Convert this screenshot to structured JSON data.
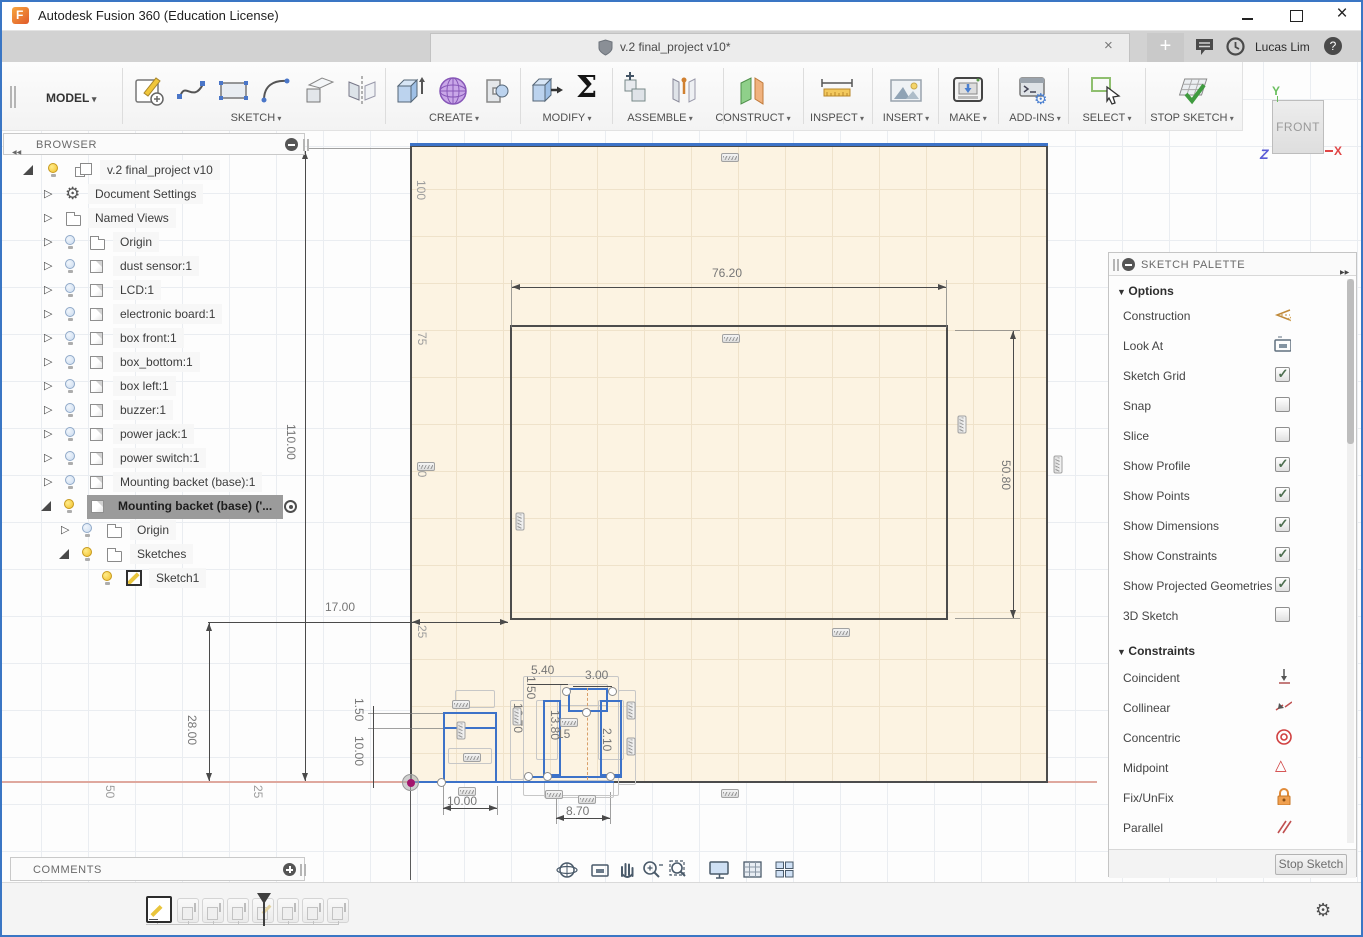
{
  "window": {
    "title": "Autodesk Fusion 360 (Education License)"
  },
  "appbar": {
    "tab_title": "v.2 final_project v10*",
    "user": "Lucas Lim",
    "left_icons": [
      "app-grid",
      "file-new",
      "save",
      "undo",
      "redo"
    ],
    "right_icons": [
      "new-tab-plus",
      "comments-bubble",
      "job-status-clock",
      "help"
    ]
  },
  "toolbar": {
    "workspace": "MODEL",
    "groups": [
      {
        "label": "SKETCH",
        "icons": [
          "create-sketch",
          "spline",
          "rectangle",
          "arc",
          "project-include",
          "mirror"
        ]
      },
      {
        "label": "CREATE",
        "icons": [
          "extrude",
          "form",
          "revolve"
        ]
      },
      {
        "label": "MODIFY",
        "icons": [
          "press-pull",
          "change-parameters"
        ]
      },
      {
        "label": "ASSEMBLE",
        "icons": [
          "new-component",
          "joint"
        ]
      },
      {
        "label": "CONSTRUCT",
        "icons": [
          "construction-plane"
        ]
      },
      {
        "label": "INSPECT",
        "icons": [
          "measure"
        ]
      },
      {
        "label": "INSERT",
        "icons": [
          "insert-image"
        ]
      },
      {
        "label": "MAKE",
        "icons": [
          "3d-print"
        ]
      },
      {
        "label": "ADD-INS",
        "icons": [
          "scripts-addins"
        ]
      },
      {
        "label": "SELECT",
        "icons": [
          "select-cursor"
        ]
      },
      {
        "label": "STOP SKETCH",
        "icons": [
          "stop-sketch"
        ]
      }
    ]
  },
  "viewcube": {
    "face": "FRONT",
    "axis_x": "X",
    "axis_y": "Y",
    "axis_z": "Z"
  },
  "browser": {
    "title": "BROWSER",
    "items": [
      {
        "label": "v.2 final_project v10",
        "icon": "component",
        "bulb": "on",
        "expanded": true
      },
      {
        "label": "Document Settings",
        "icon": "gear",
        "expanded": false
      },
      {
        "label": "Named Views",
        "icon": "folder",
        "expanded": false
      },
      {
        "label": "Origin",
        "icon": "folder",
        "bulb": "off",
        "expanded": false
      },
      {
        "label": "dust sensor:1",
        "icon": "cube",
        "bulb": "off",
        "expanded": false
      },
      {
        "label": "LCD:1",
        "icon": "cube",
        "bulb": "off",
        "expanded": false
      },
      {
        "label": "electronic board:1",
        "icon": "cube",
        "bulb": "off",
        "expanded": false
      },
      {
        "label": "box front:1",
        "icon": "cube",
        "bulb": "off",
        "expanded": false
      },
      {
        "label": "box_bottom:1",
        "icon": "cube",
        "bulb": "off",
        "expanded": false
      },
      {
        "label": "box left:1",
        "icon": "cube",
        "bulb": "off",
        "expanded": false
      },
      {
        "label": "buzzer:1",
        "icon": "cube",
        "bulb": "off",
        "expanded": false
      },
      {
        "label": "power jack:1",
        "icon": "cube",
        "bulb": "off",
        "expanded": false
      },
      {
        "label": "power switch:1",
        "icon": "cube",
        "bulb": "off",
        "expanded": false
      },
      {
        "label": "Mounting backet (base):1",
        "icon": "cube",
        "bulb": "off",
        "expanded": false
      },
      {
        "label": "Mounting backet (base) ('...",
        "icon": "cube",
        "bulb": "on",
        "expanded": true,
        "selected": true
      },
      {
        "label": "Origin",
        "icon": "folder",
        "bulb": "off",
        "expanded": false
      },
      {
        "label": "Sketches",
        "icon": "folder",
        "bulb": "on",
        "expanded": true
      },
      {
        "label": "Sketch1",
        "icon": "sketch",
        "bulb": "on"
      }
    ]
  },
  "comments": {
    "title": "COMMENTS"
  },
  "palette": {
    "title": "SKETCH PALETTE",
    "options_header": "Options",
    "constraints_header": "Constraints",
    "options": [
      {
        "label": "Construction",
        "control": "construction-icon"
      },
      {
        "label": "Look At",
        "control": "look-at-icon"
      },
      {
        "label": "Sketch Grid",
        "control": "checkbox",
        "checked": true
      },
      {
        "label": "Snap",
        "control": "checkbox",
        "checked": false
      },
      {
        "label": "Slice",
        "control": "checkbox",
        "checked": false
      },
      {
        "label": "Show Profile",
        "control": "checkbox",
        "checked": true
      },
      {
        "label": "Show Points",
        "control": "checkbox",
        "checked": true
      },
      {
        "label": "Show Dimensions",
        "control": "checkbox",
        "checked": true
      },
      {
        "label": "Show Constraints",
        "control": "checkbox",
        "checked": true
      },
      {
        "label": "Show Projected Geometries",
        "control": "checkbox",
        "checked": true
      },
      {
        "label": "3D Sketch",
        "control": "checkbox",
        "checked": false
      }
    ],
    "constraints": [
      {
        "label": "Coincident",
        "icon": "coincident-icon"
      },
      {
        "label": "Collinear",
        "icon": "collinear-icon"
      },
      {
        "label": "Concentric",
        "icon": "concentric-icon"
      },
      {
        "label": "Midpoint",
        "icon": "midpoint-icon"
      },
      {
        "label": "Fix/UnFix",
        "icon": "lock-icon"
      },
      {
        "label": "Parallel",
        "icon": "parallel-icon"
      }
    ],
    "stop_sketch": "Stop Sketch"
  },
  "dims": {
    "d110": "110.00",
    "d76": "76.20",
    "d50_80": "50.80",
    "d17": "17.00",
    "d28": "28.00",
    "d1_50a": "1.50",
    "d10a": "10.00",
    "d5_40": "5.40",
    "d3_00": "3.00",
    "d1_50b": "1.50",
    "d13_70": "13.70",
    "d13_80": "13.80",
    "d15": "15",
    "d2_10": "2.10",
    "d10b": "10.00",
    "d8_70": "8.70"
  },
  "ruler": {
    "ry100": "100",
    "ry75": "75",
    "ry50": "50",
    "ry25": "25",
    "rx25": "25",
    "rx50": "50"
  },
  "navbar": {
    "icons": [
      "orbit",
      "look-at",
      "pan",
      "zoom",
      "zoom-fit",
      "display-settings",
      "grid-display",
      "viewports"
    ]
  },
  "timeline": {
    "playback": [
      "skip-to-start",
      "step-back",
      "play",
      "step-forward",
      "skip-to-end"
    ],
    "features": [
      "sketch-active",
      "extrude",
      "extrude",
      "extrude",
      "sketch",
      "extrude",
      "extrude",
      "extrude"
    ]
  },
  "colors": {
    "accent_border": "#3a76c4",
    "selection_blue": "#3d72c8",
    "profile_beige": "#fcf3e2",
    "axis_salmon": "#dfa89e",
    "origin_magenta": "#a3156d",
    "viewcube_y": "#6abf5e",
    "viewcube_z": "#5b5bd6",
    "viewcube_x": "#e04545"
  }
}
